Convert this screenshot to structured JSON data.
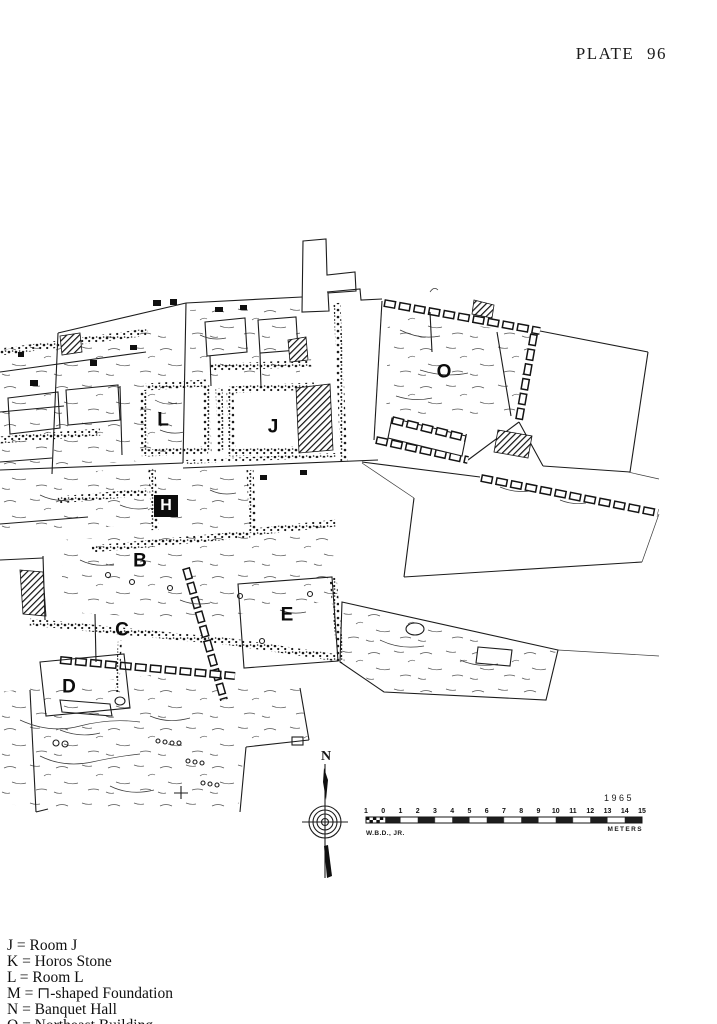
{
  "page": {
    "plate_label": "PLATE 96"
  },
  "plan": {
    "labels": [
      {
        "id": "L",
        "text": "L",
        "x": 163,
        "y": 420,
        "style": "dark"
      },
      {
        "id": "J",
        "text": "J",
        "x": 273,
        "y": 427,
        "style": "dark"
      },
      {
        "id": "O",
        "text": "O",
        "x": 444,
        "y": 372,
        "style": "dark"
      },
      {
        "id": "H",
        "text": "H",
        "x": 166,
        "y": 506,
        "style": "inverse"
      },
      {
        "id": "B",
        "text": "B",
        "x": 140,
        "y": 561,
        "style": "dark"
      },
      {
        "id": "C",
        "text": "C",
        "x": 122,
        "y": 630,
        "style": "dark"
      },
      {
        "id": "E",
        "text": "E",
        "x": 287,
        "y": 615,
        "style": "dark"
      },
      {
        "id": "D",
        "text": "D",
        "x": 69,
        "y": 687,
        "style": "dark"
      }
    ],
    "north": {
      "label": "N"
    },
    "scale_bar": {
      "tick_labels": [
        "1",
        "0",
        "1",
        "2",
        "3",
        "4",
        "5",
        "6",
        "7",
        "8",
        "9",
        "10",
        "11",
        "12",
        "13",
        "14",
        "15"
      ],
      "unit_label": "METERS",
      "year": "1965",
      "credit": "W.B.D., JR."
    }
  },
  "legend": {
    "separator": "=",
    "entries": [
      {
        "key": "J",
        "value": "Room J"
      },
      {
        "key": "K",
        "value": "Horos Stone"
      },
      {
        "key": "L",
        "value": "Room L"
      },
      {
        "key": "M",
        "value": "⊓-shaped Foundation"
      },
      {
        "key": "N",
        "value": "Banquet Hall"
      },
      {
        "key": "O",
        "value": "Northeast Building"
      }
    ]
  }
}
